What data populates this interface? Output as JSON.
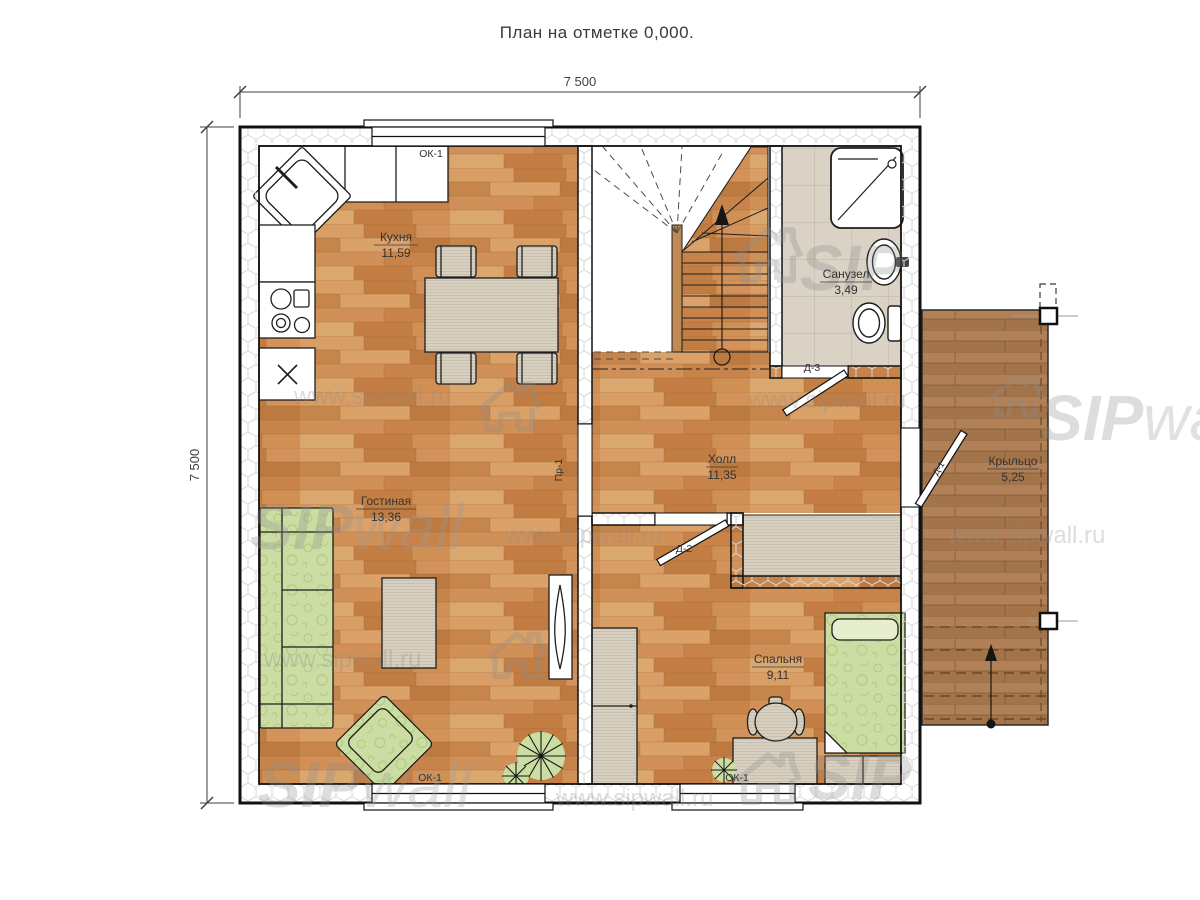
{
  "title": "План на отметке 0,000.",
  "dimensions": {
    "top": "7 500",
    "left": "7 500"
  },
  "rooms": {
    "kitchen": {
      "name": "Кухня",
      "area": "11,59"
    },
    "living": {
      "name": "Гостиная",
      "area": "13,36"
    },
    "hall": {
      "name": "Холл",
      "area": "11,35"
    },
    "bathroom": {
      "name": "Санузел",
      "area": "3,49"
    },
    "bedroom": {
      "name": "Спальня",
      "area": "9,11"
    },
    "porch": {
      "name": "Крыльцо",
      "area": "5,25"
    }
  },
  "openings": {
    "window": "ОК-1",
    "door1": "Д-1",
    "door2": "Д-2",
    "door3": "Д-3",
    "passage": "Пр-1"
  },
  "watermark": {
    "sip": "SIP",
    "wall": "wall",
    "url": "www.sipwall.ru"
  },
  "colors": {
    "wood": "#cd8d52",
    "deck": "#ab7a4c",
    "tile": "#d9d2c5",
    "fabric": "#cbdda2",
    "beige": "#d7cfc0",
    "wall_hatch": "#d7d7d7",
    "ink": "#161616"
  }
}
